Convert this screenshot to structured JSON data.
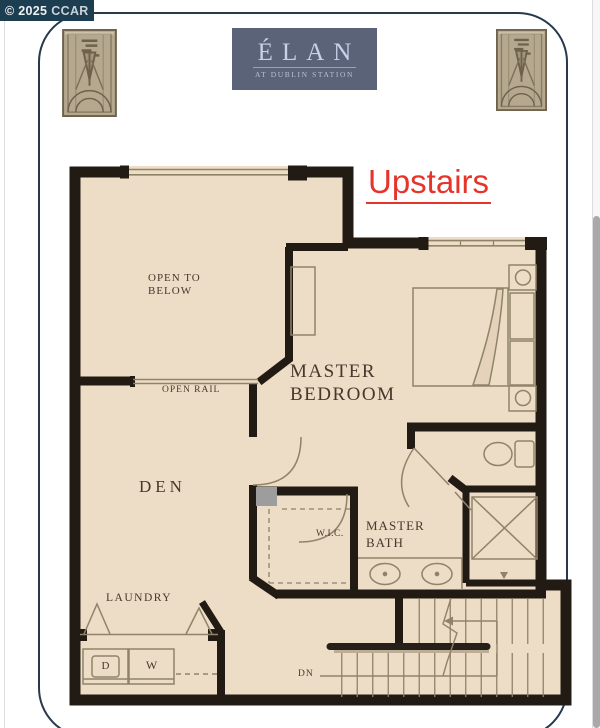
{
  "banner": {
    "copyright": "© 2025",
    "org": "CCAR"
  },
  "logo": {
    "name": "ÉLAN",
    "subtitle": "AT DUBLIN STATION"
  },
  "floor_label": "Upstairs",
  "rooms": {
    "open_to_below_1": "OPEN TO",
    "open_to_below_2": "BELOW",
    "open_rail": "OPEN RAIL",
    "master_bedroom_1": "MASTER",
    "master_bedroom_2": "BEDROOM",
    "den": "DEN",
    "wic": "W.I.C.",
    "master_bath_1": "MASTER",
    "master_bath_2": "BATH",
    "laundry": "LAUNDRY",
    "down": "DN",
    "dryer": "D",
    "washer": "W"
  },
  "colors": {
    "floor": "#eddcc6",
    "wall": "#221b14",
    "plan_line": "#8f8368",
    "label_text": "#46392c",
    "accent_red": "#e5352b",
    "logo_bg": "#5b6378",
    "logo_text": "#c8d1e9",
    "banner_bg": "#1d3d51",
    "ornament_base": "#b5a88e"
  },
  "icons": {
    "ornament": "art-deco-plaque",
    "scrollbar": "vertical-scrollbar"
  }
}
